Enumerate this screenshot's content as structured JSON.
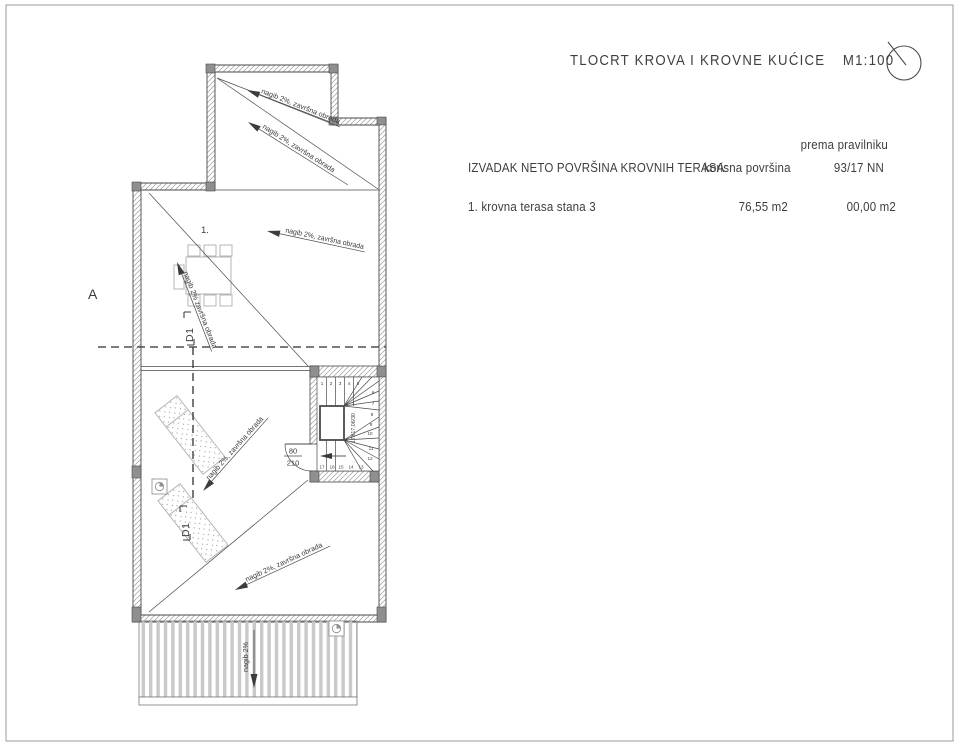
{
  "header": {
    "title": "TLOCRT KROVA I KROVNE KUĆICE",
    "scale": "M1:100",
    "compass_icon": "north-arrow"
  },
  "summary_table": {
    "col_area_header": "IZVADAK NETO POVRŠINA KROVNIH TERASA:",
    "col_usable_header": "korisna površina",
    "col_regulation_header_line1": "prema pravilniku",
    "col_regulation_header_line2": "93/17 NN",
    "rows": [
      {
        "label": "1. krovna terasa stana 3",
        "usable_area": "76,55 m2",
        "regulation_area": "00,00 m2"
      }
    ]
  },
  "plan": {
    "section_letter": "A",
    "room_number": "1.",
    "detail_marker": "D1",
    "slope_label": "nagib 2%, završna obrada",
    "slope_label_plain": "nagib 2% završna obrada",
    "slope_label_short": "nagib 2%",
    "door": {
      "width": "80",
      "height": "210"
    },
    "stair": {
      "dimension": "17X17,06/30",
      "steps": [
        "1",
        "2",
        "3",
        "4",
        "5",
        "6",
        "7",
        "8",
        "9",
        "10",
        "11",
        "12",
        "13",
        "14",
        "15",
        "16",
        "17"
      ]
    }
  },
  "colors": {
    "line": "#4a4a4a",
    "wall_hatch": "#9b9b9b",
    "furniture": "#b5b5b5",
    "stripe": "#c9c9c9",
    "column_fill": "#8f8f8f",
    "text": "#3c3c3c"
  }
}
